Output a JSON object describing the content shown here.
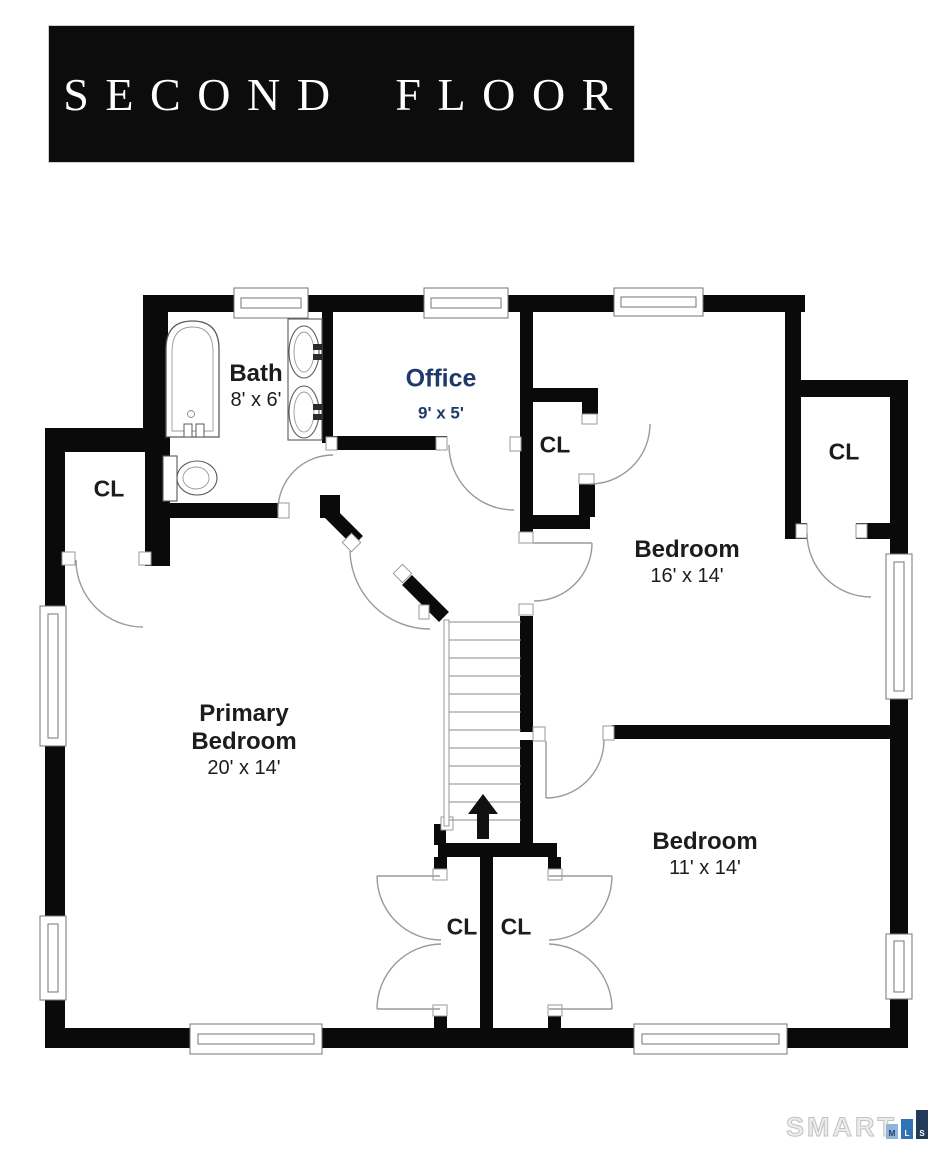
{
  "title": "SECOND FLOOR",
  "rooms": {
    "bath": {
      "name": "Bath",
      "dims": "8' x 6'"
    },
    "office": {
      "name": "Office",
      "dims": "9' x 5'"
    },
    "bedroom_right": {
      "name": "Bedroom",
      "dims": "16' x 14'"
    },
    "primary": {
      "name_line1": "Primary",
      "name_line2": "Bedroom",
      "dims": "20' x 14'"
    },
    "bedroom_lower": {
      "name": "Bedroom",
      "dims": "11' x 14'"
    }
  },
  "closet_labels": [
    "CL",
    "CL",
    "CL",
    "CL",
    "CL"
  ],
  "stairs": {
    "direction": "up"
  },
  "watermark": {
    "brand": "SMART",
    "mls": [
      {
        "letter": "M",
        "color": "#8fb6da"
      },
      {
        "letter": "L",
        "color": "#2e74b5"
      },
      {
        "letter": "S",
        "color": "#223a57"
      }
    ]
  },
  "colors": {
    "wall": "#0a0a0a",
    "room_label": "#1c1c1c",
    "office_accent": "#1f3a6a",
    "door_arc": "#9a9a9a",
    "banner_bg": "#0c0c0c",
    "banner_text": "#ffffff"
  }
}
